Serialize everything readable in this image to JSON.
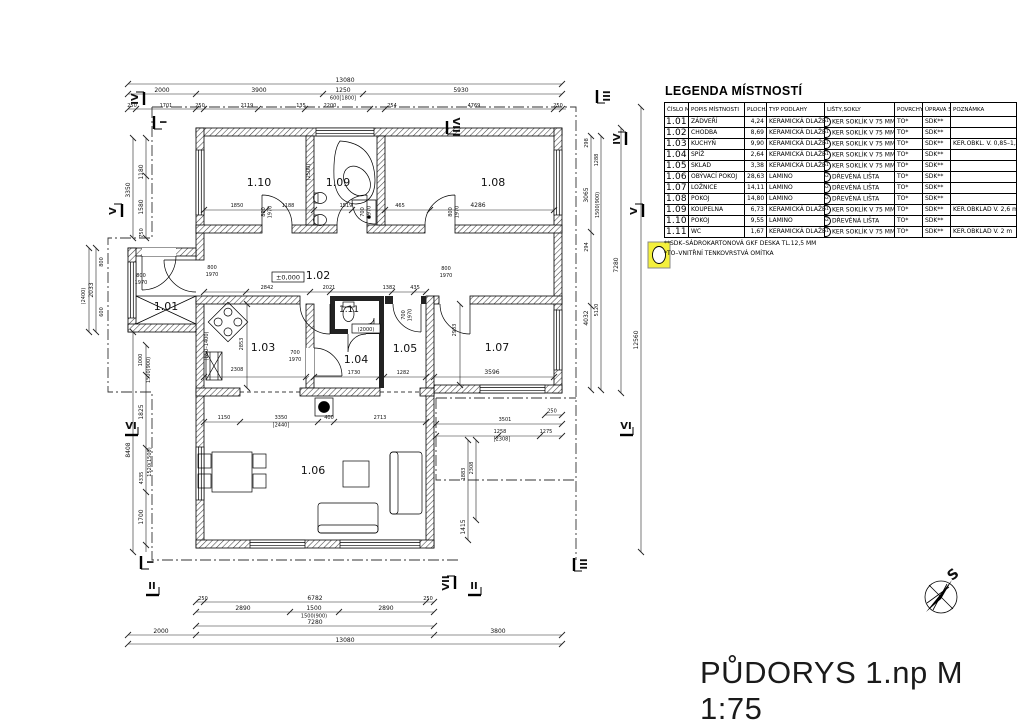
{
  "sheet": {
    "title": "PŮDORYS 1.np M 1:75",
    "compass_label": "S"
  },
  "legend": {
    "title": "LEGENDA MÍSTNOSTÍ",
    "headers": [
      "ČÍSLO MÍSTN.",
      "POPIS MÍSTNOSTI",
      "PLOCHA (m²)",
      "TYP PODLAHY",
      "LIŠTY,SOKLY",
      "POVRCHY STĚN",
      "ÚPRAVA STROPU",
      "POZNÁMKA"
    ],
    "rows": [
      {
        "num": "1.01",
        "name": "ZÁDVEŘÍ",
        "area": "4,24",
        "floor": "KERAMICKÁ DLAŽBA",
        "badge": "S1",
        "skirting": "KER SOKLÍK V 75 MM",
        "walls": "TO*",
        "ceiling": "SDK**",
        "note": ""
      },
      {
        "num": "1.02",
        "name": "CHODBA",
        "area": "8,69",
        "floor": "KERAMICKÁ DLAŽBA",
        "badge": "S1",
        "skirting": "KER SOKLÍK V 75 MM",
        "walls": "TO*",
        "ceiling": "SDK**",
        "note": ""
      },
      {
        "num": "1.03",
        "name": "KUCHYŇ",
        "area": "9,90",
        "floor": "KERAMICKÁ DLAŽBA",
        "badge": "S1",
        "skirting": "KER SOKLÍK V 75 MM",
        "walls": "TO*",
        "ceiling": "SDK**",
        "note": "KER.OBKL. V. 0,85–1,4 m"
      },
      {
        "num": "1.04",
        "name": "SPÍŽ",
        "area": "2,64",
        "floor": "KERAMICKÁ DLAŽBA",
        "badge": "S1",
        "skirting": "KER SOKLÍK V 75 MM",
        "walls": "TO*",
        "ceiling": "SDK**",
        "note": ""
      },
      {
        "num": "1.05",
        "name": "SKLAD",
        "area": "3,38",
        "floor": "KERAMICKÁ DLAŽBA",
        "badge": "S1",
        "skirting": "KER SOKLÍK V 75 MM",
        "walls": "TO*",
        "ceiling": "SDK**",
        "note": ""
      },
      {
        "num": "1.06",
        "name": "OBÝVACÍ POKOJ",
        "area": "28,63",
        "floor": "LAMINO",
        "badge": "S2",
        "skirting": "DŘEVĚNÁ LIŠTA",
        "walls": "TO*",
        "ceiling": "SDK**",
        "note": ""
      },
      {
        "num": "1.07",
        "name": "LOŽNICE",
        "area": "14,11",
        "floor": "LAMINO",
        "badge": "S2",
        "skirting": "DŘEVĚNÁ LIŠTA",
        "walls": "TO*",
        "ceiling": "SDK**",
        "note": ""
      },
      {
        "num": "1.08",
        "name": "POKOJ",
        "area": "14,80",
        "floor": "LAMINO",
        "badge": "S2",
        "skirting": "DŘEVĚNÁ LIŠTA",
        "walls": "TO*",
        "ceiling": "SDK**",
        "note": ""
      },
      {
        "num": "1.09",
        "name": "KOUPELNA",
        "area": "6,73",
        "floor": "KERAMICKÁ DLAŽBA",
        "badge": "S1",
        "skirting": "KER SOKLÍK V 75 MM",
        "walls": "TO*",
        "ceiling": "SDK**",
        "note": "KER.OBKLAD V. 2,6 m"
      },
      {
        "num": "1.10",
        "name": "POKOJ",
        "area": "9,55",
        "floor": "LAMINO",
        "badge": "S2",
        "skirting": "DŘEVĚNÁ LIŠTA",
        "walls": "TO*",
        "ceiling": "SDK**",
        "note": ""
      },
      {
        "num": "1.11",
        "name": "WC",
        "area": "1,67",
        "floor": "KERAMICKÁ DLAŽBA",
        "badge": "S1",
        "skirting": "KER SOKLÍK V 75 MM",
        "walls": "TO*",
        "ceiling": "SDK**",
        "note": "KER.OBKLAD V. 2 m"
      }
    ],
    "notes": [
      "**SDK–SÁDROKARTONOVÁ GKF DESKA TL.12,5 MM",
      "*TO–VNITŘNÍ TENKOVRSTVÁ OMÍTKA"
    ]
  },
  "plan": {
    "rooms": {
      "r101": "1.01",
      "r102": "1.02",
      "r103": "1.03",
      "r104": "1.04",
      "r105": "1.05",
      "r106": "1.06",
      "r107": "1.07",
      "r108": "1.08",
      "r109": "1.09",
      "r110": "1.10",
      "r111": "1.11"
    },
    "level_mark": "±0,000",
    "sections": {
      "i": "I",
      "ii": "II",
      "iii": "III",
      "iv": "IV",
      "v": "V",
      "vi": "VI",
      "vii": "VII",
      "viii": "VIII"
    },
    "door_sizes": {
      "w700": "700",
      "w800": "800",
      "h1970": "1970"
    },
    "dims": {
      "top_total": "13080",
      "t_2000": "2000",
      "t_3900": "3900",
      "t_1250": "1250",
      "t_600": "600[1800]",
      "t_5930": "5930",
      "t3_250a": "250",
      "t3_1701": "1701",
      "t3_250b": "250",
      "t3_2119": "2119",
      "t3_135": "135",
      "t3_2200": "2200",
      "t3_254": "254",
      "t3_4769": "4769",
      "t3_250c": "250",
      "b_250a": "250",
      "b_6782": "6782",
      "b_250b": "250",
      "b_2890a": "2890",
      "b_1500": "1500",
      "b_1500b": "1500(900)",
      "b_2890b": "2890",
      "b_7280": "7280",
      "b_2000": "2000",
      "b_3800": "3800",
      "b_total": "13080",
      "l_1180": "1180",
      "l_1580": "1580",
      "l_3350": "3350",
      "l_750": "750",
      "l_2400": "(2400)",
      "l_2033": "2033",
      "l_800": "800",
      "l_600": "600",
      "l_1000": "1000",
      "l_1500": "1500(900)",
      "l_1825": "1825",
      "l_8408": "8408",
      "l_1520": "1520(1500)",
      "l_4335": "4335",
      "l_1700": "1700",
      "r_298": "298",
      "r_1288": "1288",
      "r_3065": "3065",
      "r_1500": "1500(900)",
      "r_294": "294",
      "r_7280": "7280",
      "r_4032": "4032",
      "r_5120": "5120",
      "r_12560": "12560",
      "rw_3501": "3501",
      "rw_250": "250",
      "rw_1258": "1258",
      "rw_1275": "1275",
      "rw_2308": "[2308]",
      "rw_1415": "1415",
      "rw_1883": "1883",
      "rw_2308b": "2308",
      "i_1850": "1850",
      "i_1188": "1188",
      "i_1519": "1519",
      "i_465": "465",
      "i_4286": "4286",
      "i_2500": "(2500)",
      "i_2842": "2842",
      "i_2021": "2021",
      "i_1382": "1382",
      "i_435": "435",
      "i_2308k": "2308",
      "i_2853": "2853",
      "i_b50": "(B50–1400)",
      "i_1730": "1730",
      "i_1282": "1282",
      "i_3596": "3596",
      "i_2933": "2933",
      "i_2000": "(2000)",
      "i_1150": "1150",
      "i_3350": "3350",
      "i_2440": "[2440]",
      "i_400": "400",
      "i_2713": "2713"
    }
  }
}
